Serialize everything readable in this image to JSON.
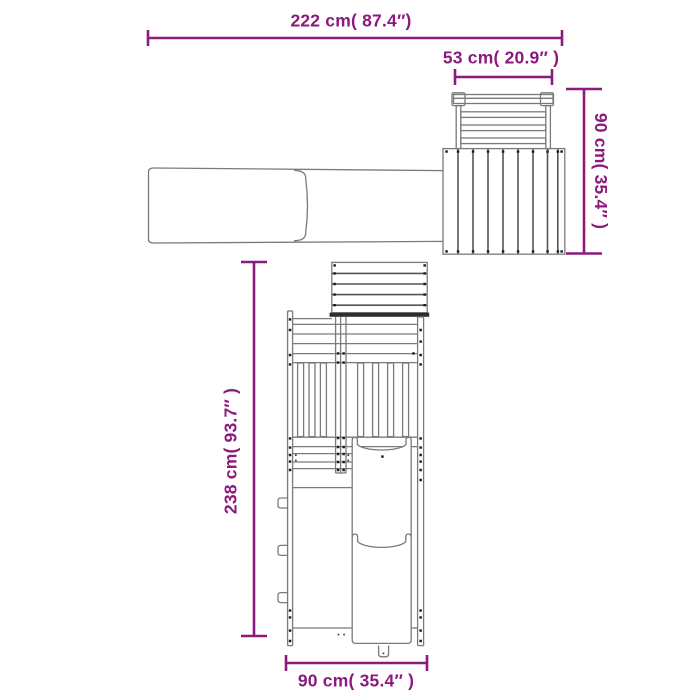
{
  "canvas": {
    "width": 700,
    "height": 700,
    "background": "#ffffff"
  },
  "colors": {
    "dimension_accent": "#8c1a7d",
    "drawing_line": "#7a7a7a",
    "drawing_dark_edge": "#2e2e2e",
    "screw_dot": "#1c1c1c"
  },
  "dimensions": {
    "total_width": {
      "cm": "222",
      "inches": "87.4",
      "label": "222 cm( 87.4″)"
    },
    "platform_width": {
      "cm": "53",
      "inches": "20.9",
      "label": "53 cm( 20.9″ )"
    },
    "platform_depth": {
      "cm": "90",
      "inches": "35.4",
      "label": "90 cm( 35.4″ )"
    },
    "unit_length": {
      "cm": "238",
      "inches": "93.7",
      "label": "238 cm( 93.7″ )"
    },
    "tower_width": {
      "cm": "90",
      "inches": "35.4",
      "label": "90 cm( 35.4″ )"
    }
  }
}
